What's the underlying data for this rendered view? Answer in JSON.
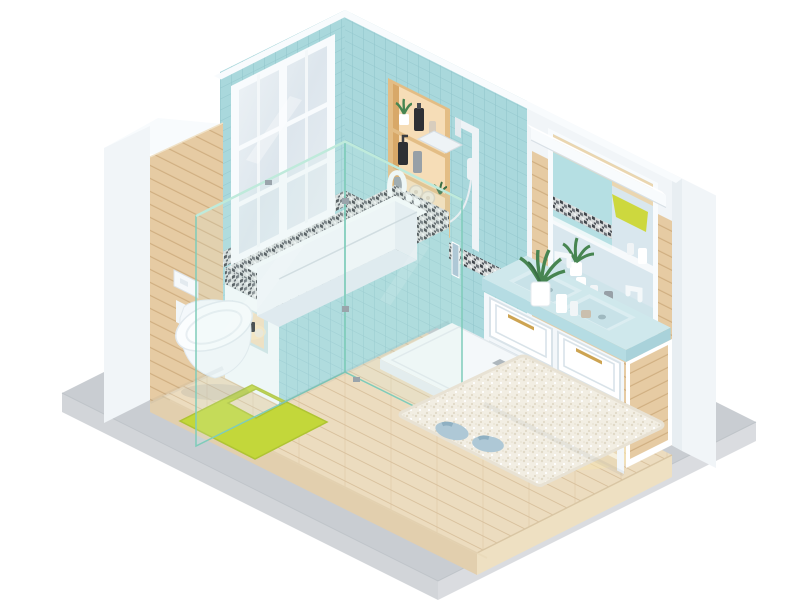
{
  "scene": {
    "description": "Isometric 3D render of a modern bathroom diorama floating on a concrete slab, white background",
    "style": "soft-lit low-poly isometric cutaway, two walls visible",
    "room": "bathroom",
    "objects": [
      {
        "name": "concrete-base-slab"
      },
      {
        "name": "raised-wood-plank-floor"
      },
      {
        "name": "window-wall",
        "parts": [
          "teal-mosaic-tile",
          "large-white-framed-window"
        ]
      },
      {
        "name": "tiled-shower-wall",
        "parts": [
          "teal-square-tile",
          "pebble-mosaic-border-band"
        ]
      },
      {
        "name": "recessed-storage-niche",
        "items": [
          "potted-plant",
          "black-bottle",
          "cream-tube",
          "black-pump-bottle",
          "gray-bottle",
          "rolled-towels",
          "small-plant"
        ]
      },
      {
        "name": "rain-shower-set",
        "parts": [
          "square-rain-head",
          "riser-rail",
          "hand-shower",
          "hose"
        ]
      },
      {
        "name": "glass-shower-enclosure",
        "parts": [
          "fixed-panel",
          "hinged-door",
          "metal-clips",
          "door-handle"
        ]
      },
      {
        "name": "white-shower-tray",
        "parts": [
          "square-drain"
        ]
      },
      {
        "name": "bathtub",
        "parts": [
          "pebble-mosaic-rim",
          "white-inner-rim",
          "teal-tile-apron",
          "lit-side-niche-with-jars",
          "white-faucet"
        ]
      },
      {
        "name": "wood-paneled-pillar"
      },
      {
        "name": "wall-hung-toilet",
        "parts": [
          "white-flush-plate"
        ]
      },
      {
        "name": "u-shaped-toilet-mat"
      },
      {
        "name": "pair-of-slippers"
      },
      {
        "name": "shaggy-bath-rug"
      },
      {
        "name": "double-sink-vanity",
        "parts": [
          "four-drawers",
          "brass-handles",
          "blue-stone-countertop",
          "two-basins",
          "white-faucets",
          "aloe-plant",
          "toiletry-bottles",
          "wood-side-panel",
          "open-lower-shelf"
        ]
      },
      {
        "name": "framed-mirror",
        "reflection": [
          "wood-planks",
          "teal-tile",
          "mosaic-band",
          "yellow-towel",
          "aloe-plant",
          "countertop"
        ]
      },
      {
        "name": "vanity-light-bar"
      },
      {
        "name": "backsplash-ledge-with-bottles"
      },
      {
        "name": "wood-plank-accent-wall"
      }
    ]
  },
  "palette": {
    "background": "#ffffff",
    "slab_top": "#c9cdd2",
    "slab_left": "#d2d5d9",
    "slab_right": "#dadce0",
    "floor_top": "#ecdcbf",
    "floor_line": "#d8c09c",
    "floor_front_left": "#e2cfae",
    "floor_front_right": "#eee0c2",
    "tile": "#a9d8dc",
    "tile_grout": "#92c6cc",
    "wall_white": "#f1f5f8",
    "cap_white": "#f8fbfd",
    "wood_panel": "#e6cba3",
    "wood_line": "#cfae80",
    "niche_wood": "#e3bd85",
    "niche_wood_light": "#f6ddb7",
    "niche_wood_shade": "#d8a868",
    "mosaic_base": "#d8dcdc",
    "mosaic_dark": "#41464b",
    "mosaic_mid": "#6b7076",
    "tub_white": "#f5f9fb",
    "tub_back": "#f2f6f9",
    "tub_end": "#e7eef3",
    "tub_bottom": "#e2eaf1",
    "counter": "#cfe8ec",
    "counter_edge": "#b5dce3",
    "sink": "#dbedf1",
    "cabinet": "#f3f7fa",
    "gold": "#cda452",
    "mirror_glass": "#d9e7ee",
    "towel_yellow": "#cdd83e",
    "mat_green": "#c3d73a",
    "slipper_blue": "#aec8d6",
    "rug": "#f2eee3",
    "rug_dot": "#e0d9c7",
    "leaf": "#478551",
    "leaf_dark": "#3a6f45",
    "glass_edge": "#7fccba",
    "glass_top_edge": "#bfeadb",
    "fixture_white": "#eef3f6",
    "tray_white": "#f4f8fa",
    "warm_glow": "#f5e3b3",
    "bottle_black": "#2e3034",
    "bottle_gray": "#97a0a7",
    "towel_roll": "#eee7d7"
  }
}
